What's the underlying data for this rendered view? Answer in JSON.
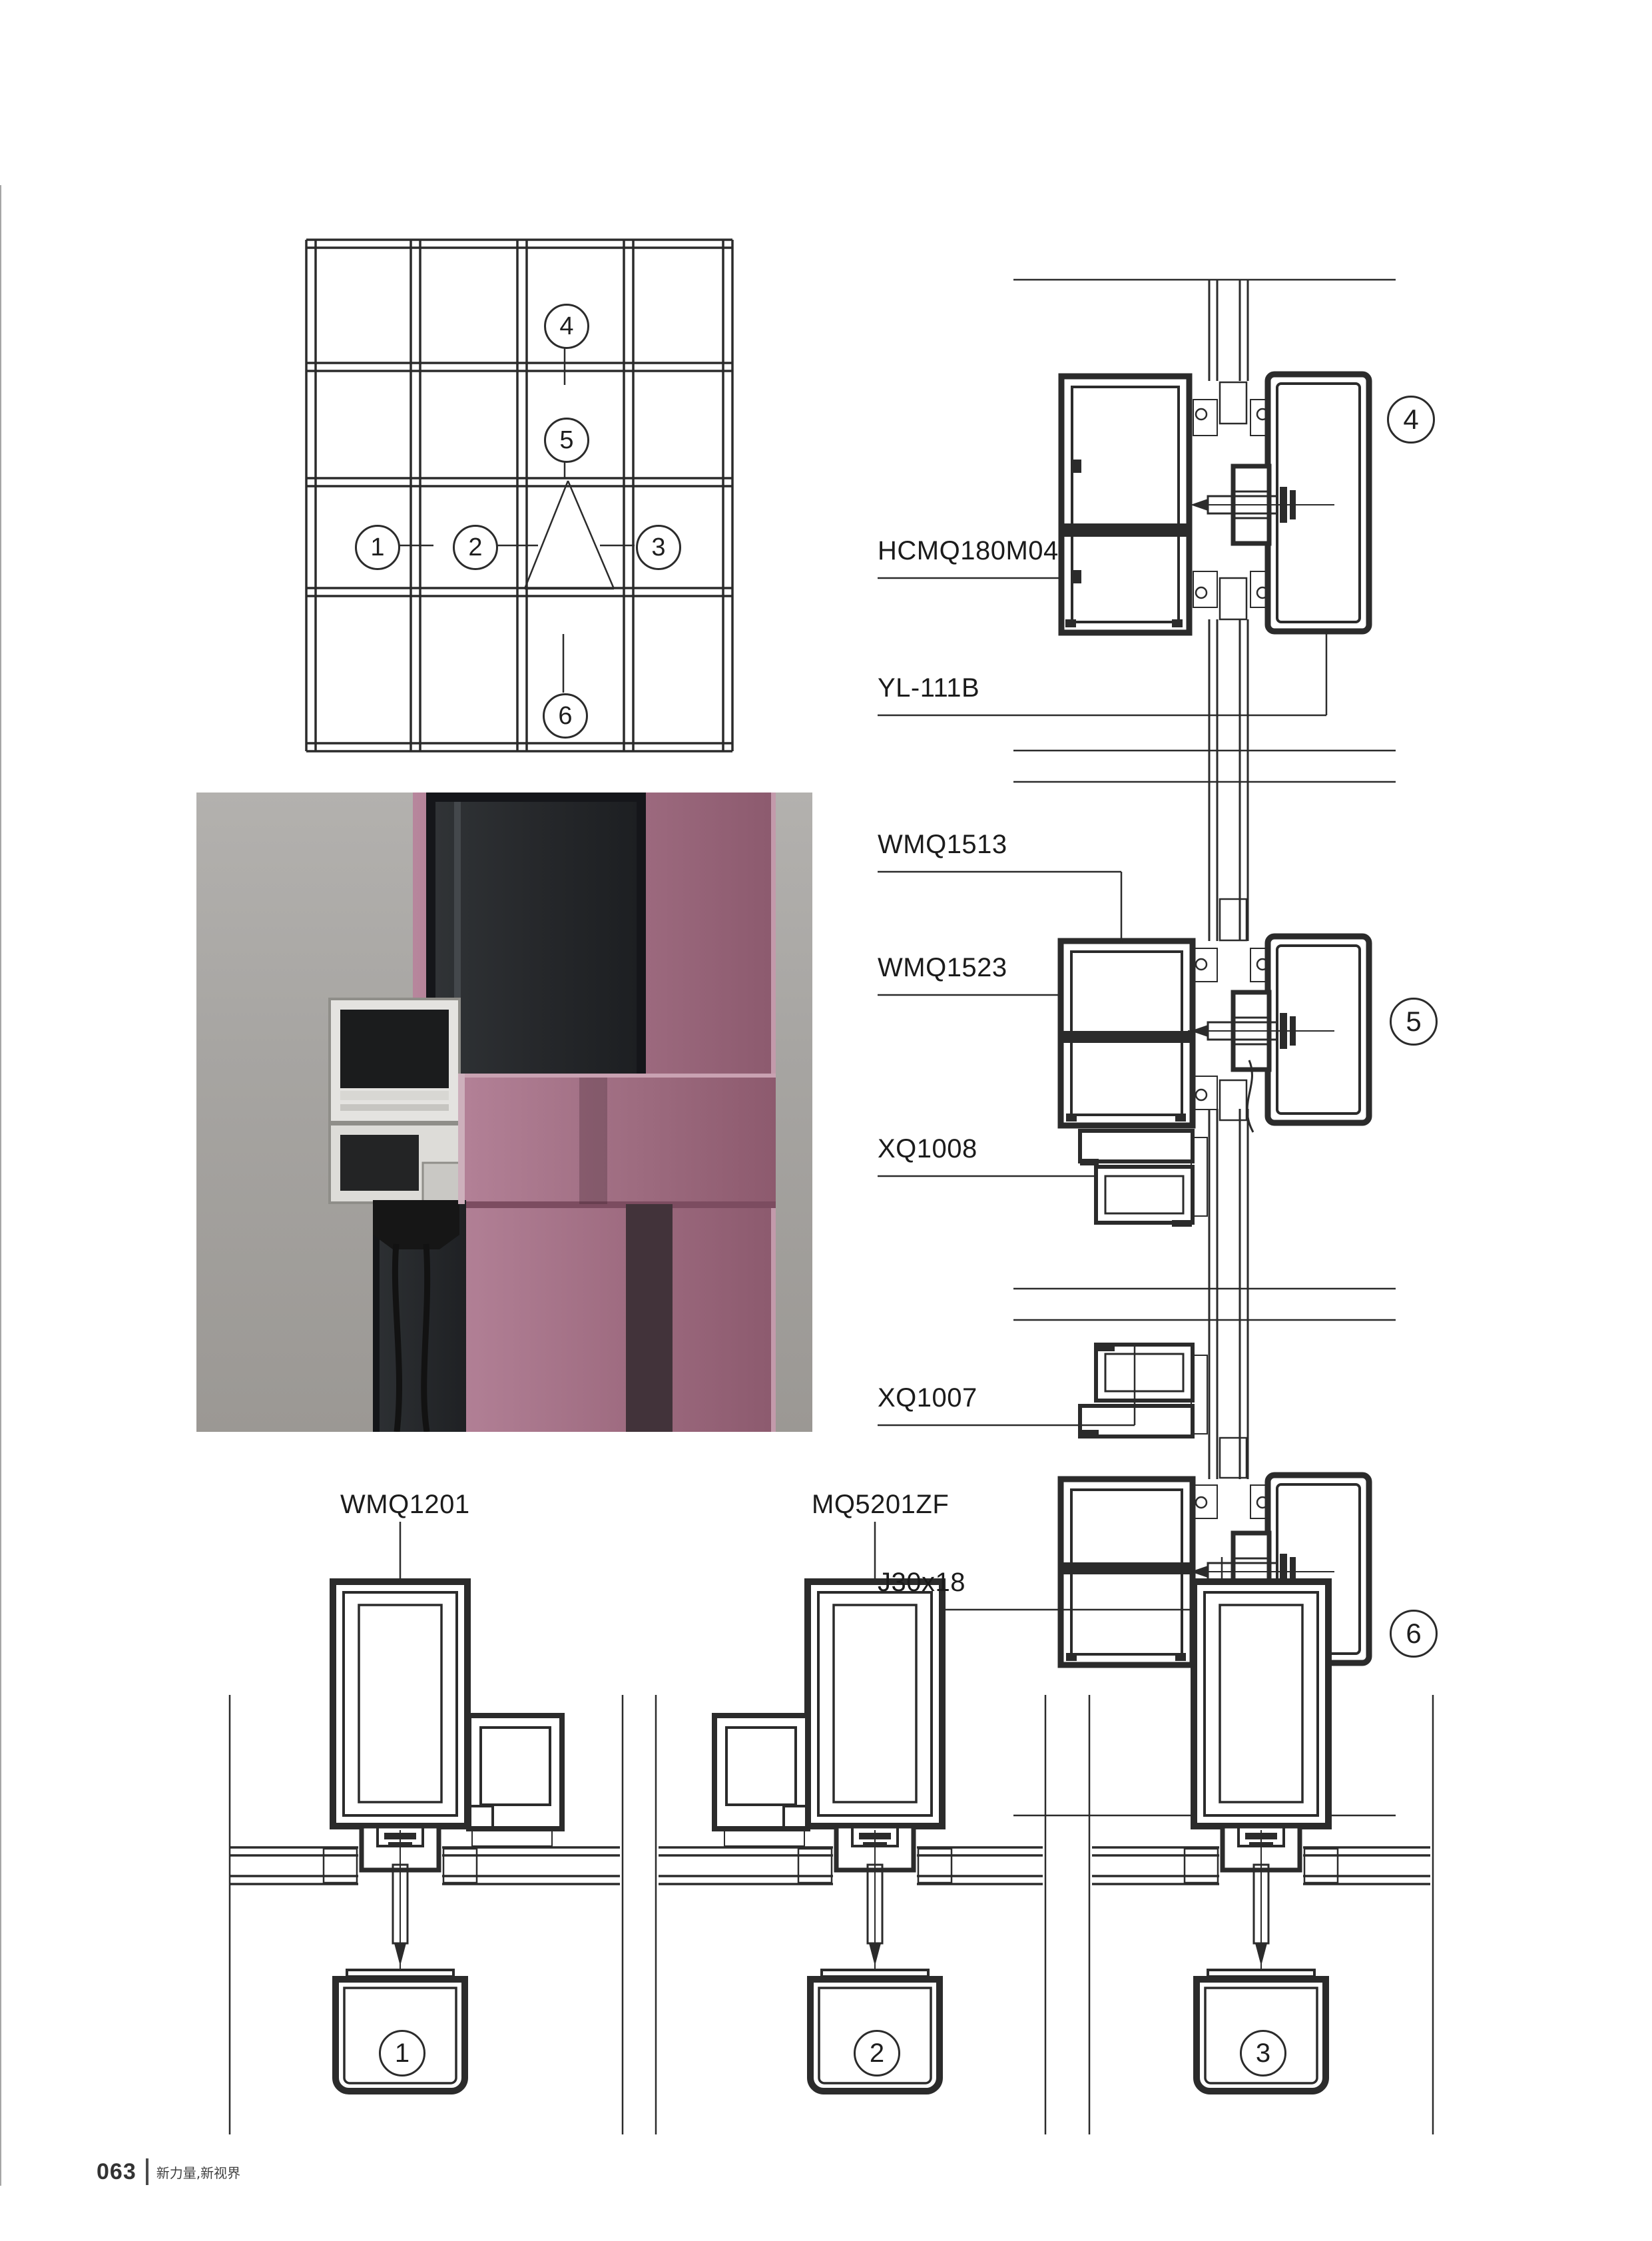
{
  "page": {
    "type": "aluminum curtain-wall profile catalog page",
    "background": "#ffffff",
    "footer": {
      "page_number": "063",
      "slogan": "新力量,新视界"
    }
  },
  "colors": {
    "line": "#2b2b2b",
    "render_background": "#a7a5a2",
    "render_mullion_rose": "#9c6a7e",
    "render_glass": "#26282b",
    "render_aluminum": "#e4e3e0"
  },
  "elevation_plan": {
    "callout_1": "1",
    "callout_2": "2",
    "callout_3": "3",
    "callout_4": "4",
    "callout_5": "5",
    "callout_6": "6"
  },
  "profile_labels": {
    "hcmq180m04": "HCMQ180M04",
    "yl111b": "YL-111B",
    "wmq1513": "WMQ1513",
    "wmq1523": "WMQ1523",
    "xq1008": "XQ1008",
    "xq1007": "XQ1007",
    "j30x18": "J30x18",
    "wmq1201": "WMQ1201",
    "mq5201zf": "MQ5201ZF"
  },
  "section_callouts": {
    "detail_1": "1",
    "detail_2": "2",
    "detail_3": "3",
    "detail_4": "4",
    "detail_5": "5",
    "detail_6": "6"
  }
}
